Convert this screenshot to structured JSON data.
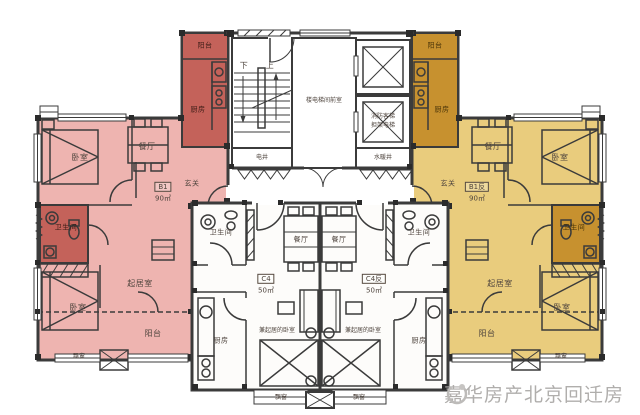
{
  "watermark": {
    "text": "嘉华房产北京回迁房"
  },
  "units": {
    "b1": {
      "code": "B1",
      "area": "90㎡"
    },
    "b1_rev": {
      "code": "B1反",
      "area": "90㎡"
    },
    "c4": {
      "code": "C4",
      "area": "50㎡"
    },
    "c4_rev": {
      "code": "C4反",
      "area": "50㎡"
    }
  },
  "rooms": {
    "balcony": "阳台",
    "kitchen": "厨房",
    "dining": "餐厅",
    "bedroom": "卧室",
    "entry": "玄关",
    "bathroom": "卫生间",
    "living": "起居室",
    "living_bedroom": "兼起居的卧室",
    "bay_window": "飘窗"
  },
  "core": {
    "stairs_down": "下",
    "stairs_up": "上",
    "lobby": "楼电梯间前室",
    "fire_elevator_line1": "消防客梯",
    "fire_elevator_line2": "担架电梯",
    "electrical_shaft": "电井",
    "plumbing_shaft": "水暖井"
  },
  "colors": {
    "b1_light": "#eeb4b0",
    "b1_dark": "#c4625a",
    "b1_rev_light": "#e9cc7d",
    "b1_rev_dark": "#c7912f",
    "wall": "#3b3b3b"
  }
}
